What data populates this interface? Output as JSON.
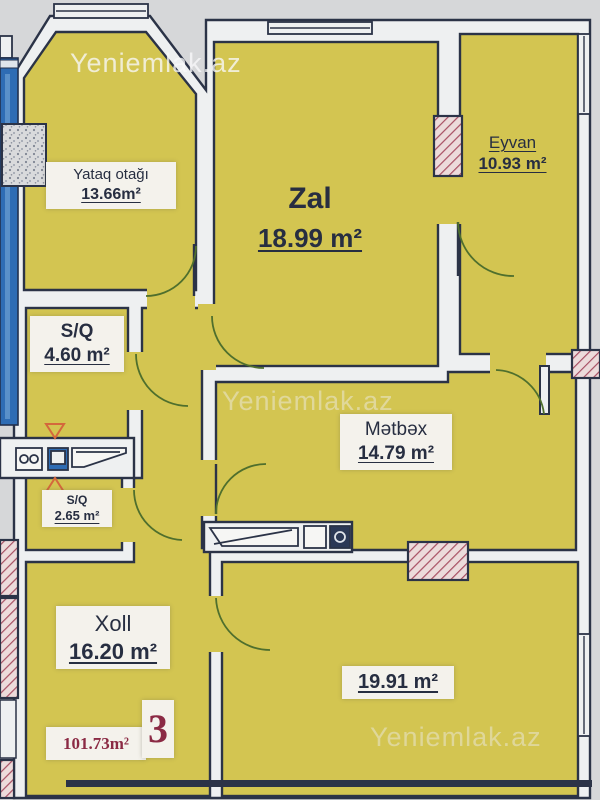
{
  "watermark": {
    "text": "Yeniemlak.az"
  },
  "rooms": {
    "bedroom": {
      "name": "Yataq otağı",
      "area": "13.66m²"
    },
    "living": {
      "name": "Zal",
      "area": "18.99 m²"
    },
    "balcony": {
      "name": "Eyvan",
      "area": "10.93 m²"
    },
    "bath": {
      "name": "S/Q",
      "area": "4.60 m²"
    },
    "wc": {
      "name": "S/Q",
      "area": "2.65 m²"
    },
    "kitchen": {
      "name": "Mətbəx",
      "area": "14.79 m²"
    },
    "hall": {
      "name": "Xoll",
      "area": "16.20 m²"
    },
    "room2": {
      "area": "19.91 m²"
    }
  },
  "summary": {
    "total_area": "101.73m²",
    "unit_number": "3"
  },
  "colors": {
    "room_fill": "#d3c551",
    "wall_line": "#2b3347",
    "wall_fill": "#eef0f1",
    "background": "#d6d7d9",
    "adjacent_blue": "#2e6cb4",
    "hatch_red": "#a84f63",
    "door_arc_green": "#4f6f2d",
    "label_maroon": "#8b2a44"
  }
}
